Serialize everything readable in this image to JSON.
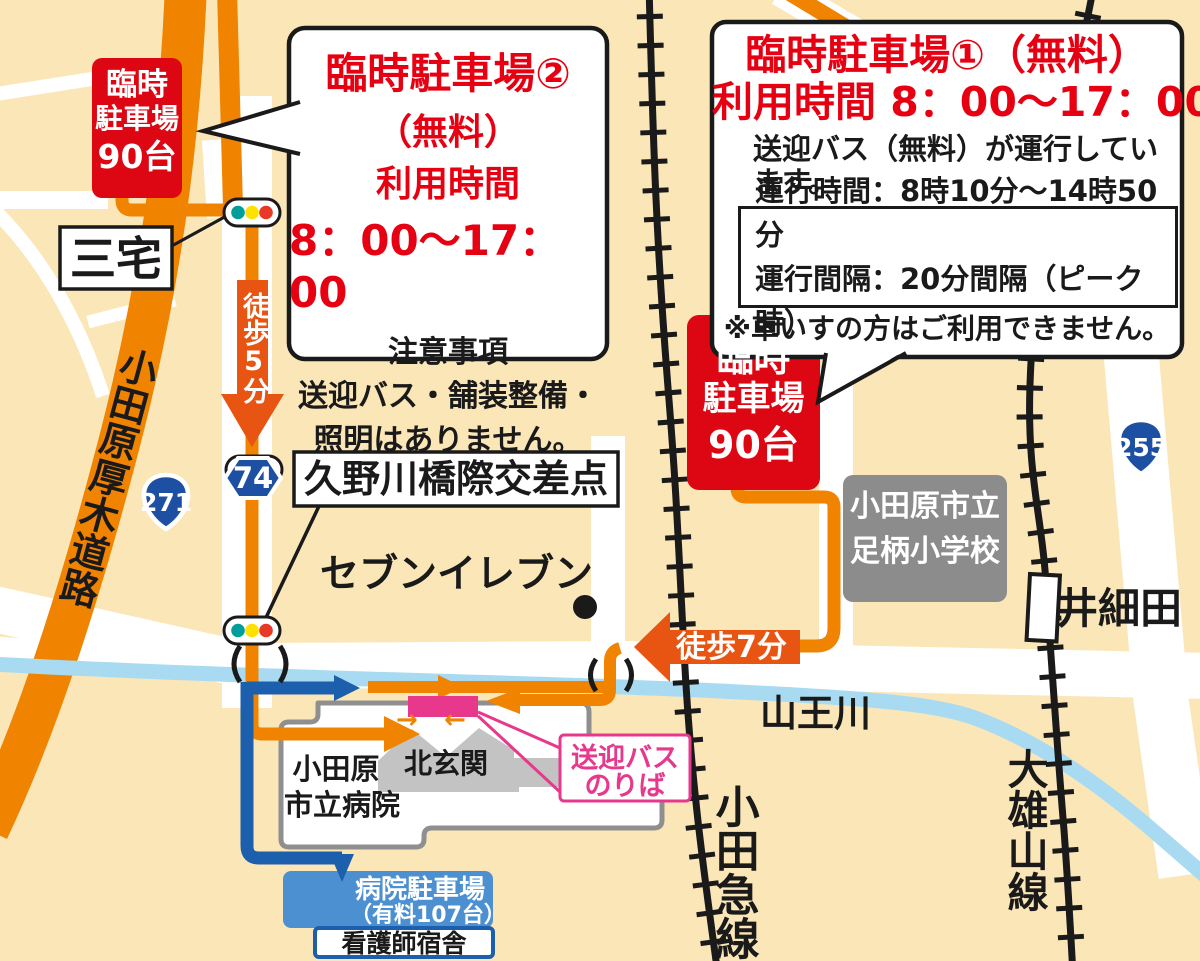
{
  "callout1": {
    "title": "臨時駐車場①（無料）",
    "hours": "利用時間  8：00～17：00",
    "body1": "送迎バス（無料）が運行してい",
    "body2": "ます。",
    "schedule1": "運行時間：8時10分～14時50分",
    "schedule2": "運行間隔：20分間隔（ピーク時）",
    "warning": "※車いすの方はご利用できません。"
  },
  "callout2": {
    "title": "臨時駐車場②",
    "fee": "（無料）",
    "hours_label": "利用時間",
    "hours": "8：00～17：00",
    "note_title": "注意事項",
    "note1": "送迎バス・舗装整備・",
    "note2": "照明はありません。"
  },
  "parking1_badge": {
    "line1": "臨時",
    "line2": "駐車場",
    "line3": "90台"
  },
  "parking2_badge": {
    "line1": "臨時",
    "line2": "駐車場",
    "line3": "90台"
  },
  "places": {
    "miyake": "三宅",
    "intersection": "久野川橋際交差点",
    "seven_eleven": "セブンイレブン",
    "school1": "小田原市立",
    "school2": "足柄小学校",
    "hospital1": "小田原",
    "hospital2": "市立病院",
    "north_entrance": "北玄関",
    "bus_stop1": "送迎バス",
    "bus_stop2": "のりば",
    "hospital_parking1": "病院駐車場",
    "hospital_parking2": "（有料107台）",
    "nurse_dorm": "看護師宿舎",
    "isaida_station": "井細田"
  },
  "roads": {
    "odawara_atsugi": "小田原厚木道路",
    "route271": "271",
    "route74": "74",
    "route255": "255"
  },
  "railways": {
    "odakyu": "小田急線",
    "daiyuzan": "大雄山線"
  },
  "river": {
    "sanno": "山王川"
  },
  "walk_labels": {
    "walk5": "徒歩5分",
    "walk7": "徒歩7分"
  },
  "icons": {
    "entry_right_arrow": "→",
    "entry_left_arrow": "←"
  },
  "colors": {
    "background": "#FBE6B8",
    "road_white": "#FFFFFF",
    "highway_orange": "#F08300",
    "route_orange": "#F08300",
    "walk_arrow_orange": "#E85412",
    "route_blue": "#1C5FAD",
    "parking_label_blue": "#4D90D2",
    "river_blue": "#A8DBF2",
    "rail_black": "#1A1A1A",
    "badge_red": "#DD0613",
    "text_red": "#E60012",
    "school_gray": "#8C8C8C",
    "entrance_gray": "#C3C3C3",
    "pink": "#E7388C",
    "shield_blue": "#1D50A2",
    "signal_teal": "#009E9B",
    "signal_yellow": "#FFE100",
    "signal_red": "#E83828"
  }
}
